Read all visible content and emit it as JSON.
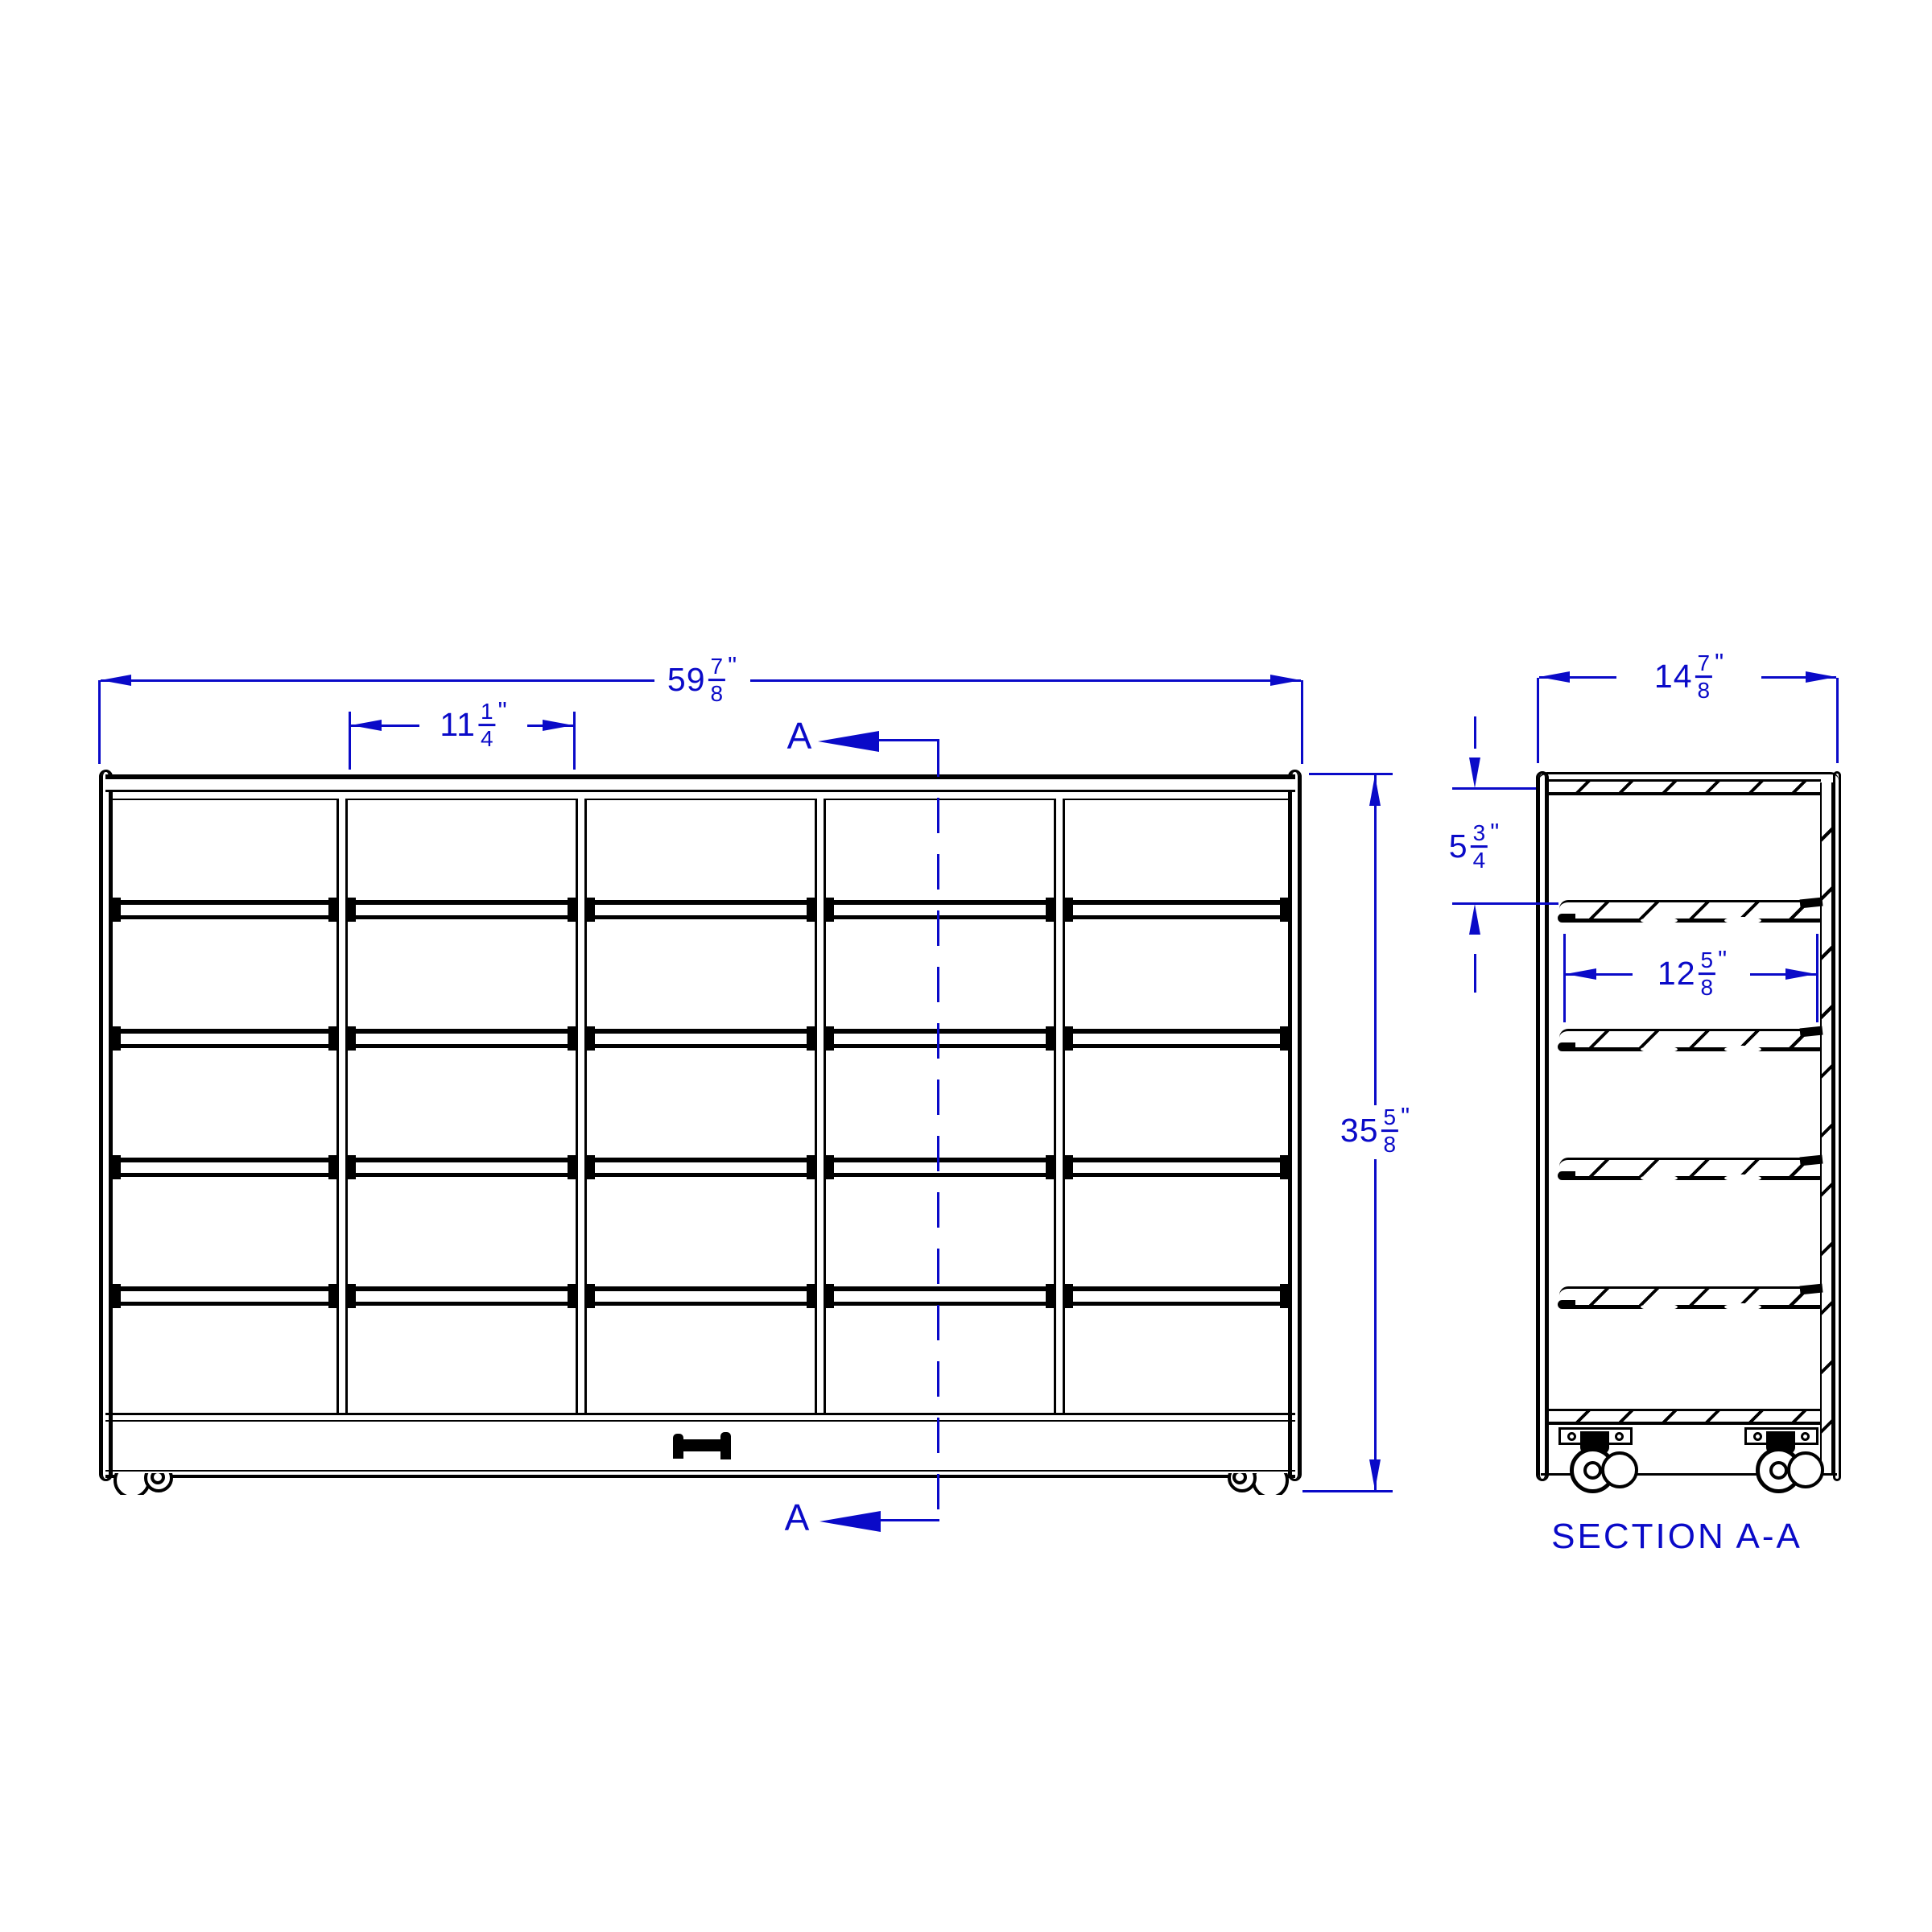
{
  "colors": {
    "line": "#000000",
    "dimension": "#0a0ac8",
    "background": "#ffffff"
  },
  "views": {
    "front": {
      "name": "front elevation",
      "overall_width": {
        "whole": "59",
        "num": "7",
        "den": "8",
        "unit": "\""
      },
      "opening_width": {
        "whole": "11",
        "num": "1",
        "den": "4",
        "unit": "\""
      },
      "overall_height": {
        "whole": "35",
        "num": "5",
        "den": "8",
        "unit": "\""
      },
      "section_marker": "A",
      "columns": 5,
      "tray_rows": 5,
      "rails_per_column": 4
    },
    "section": {
      "label": "SECTION A-A",
      "overall_depth": {
        "whole": "14",
        "num": "7",
        "den": "8",
        "unit": "\""
      },
      "row_height": {
        "whole": "5",
        "num": "3",
        "den": "4",
        "unit": "\""
      },
      "shelf_depth": {
        "whole": "12",
        "num": "5",
        "den": "8",
        "unit": "\""
      },
      "shelf_count": 4,
      "caster_count": 2
    }
  }
}
